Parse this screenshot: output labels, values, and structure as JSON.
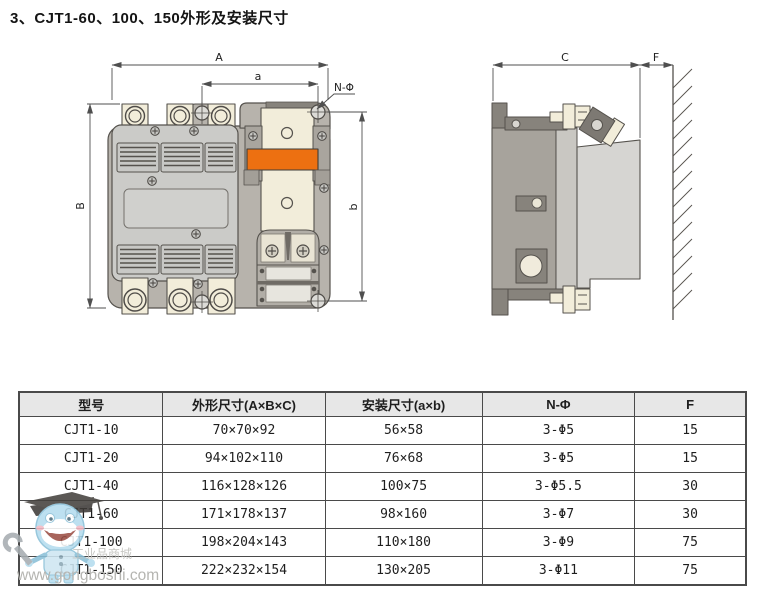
{
  "title": "3、CJT1-60、100、150外形及安装尺寸",
  "drawing": {
    "front_view": {
      "dim_width": "A",
      "dim_mount_width": "a",
      "dim_height": "B",
      "dim_mount_height": "b",
      "hole_callout": "N-Φ"
    },
    "side_view": {
      "dim_depth": "C",
      "dim_clearance": "F"
    }
  },
  "table": {
    "headers": [
      "型号",
      "外形尺寸(A×B×C)",
      "安装尺寸(a×b)",
      "N-Φ",
      "F"
    ],
    "rows": [
      [
        "CJT1-10",
        "70×70×92",
        "56×58",
        "3-Φ5",
        "15"
      ],
      [
        "CJT1-20",
        "94×102×110",
        "76×68",
        "3-Φ5",
        "15"
      ],
      [
        "CJT1-40",
        "116×128×126",
        "100×75",
        "3-Φ5.5",
        "30"
      ],
      [
        "CJT1-60",
        "171×178×137",
        "98×160",
        "3-Φ7",
        "30"
      ],
      [
        "CJT1-100",
        "198×204×143",
        "110×180",
        "3-Φ9",
        "75"
      ],
      [
        "CJT1-150",
        "222×232×154",
        "130×205",
        "3-Φ11",
        "75"
      ]
    ]
  },
  "watermark": {
    "brand_cn": "工业品商城",
    "site": "www.gongboshi.com"
  },
  "colors": {
    "coil_orange": "#ed7011",
    "terminal_cream": "#f2edda",
    "table_header_bg": "#e7e7e7"
  }
}
